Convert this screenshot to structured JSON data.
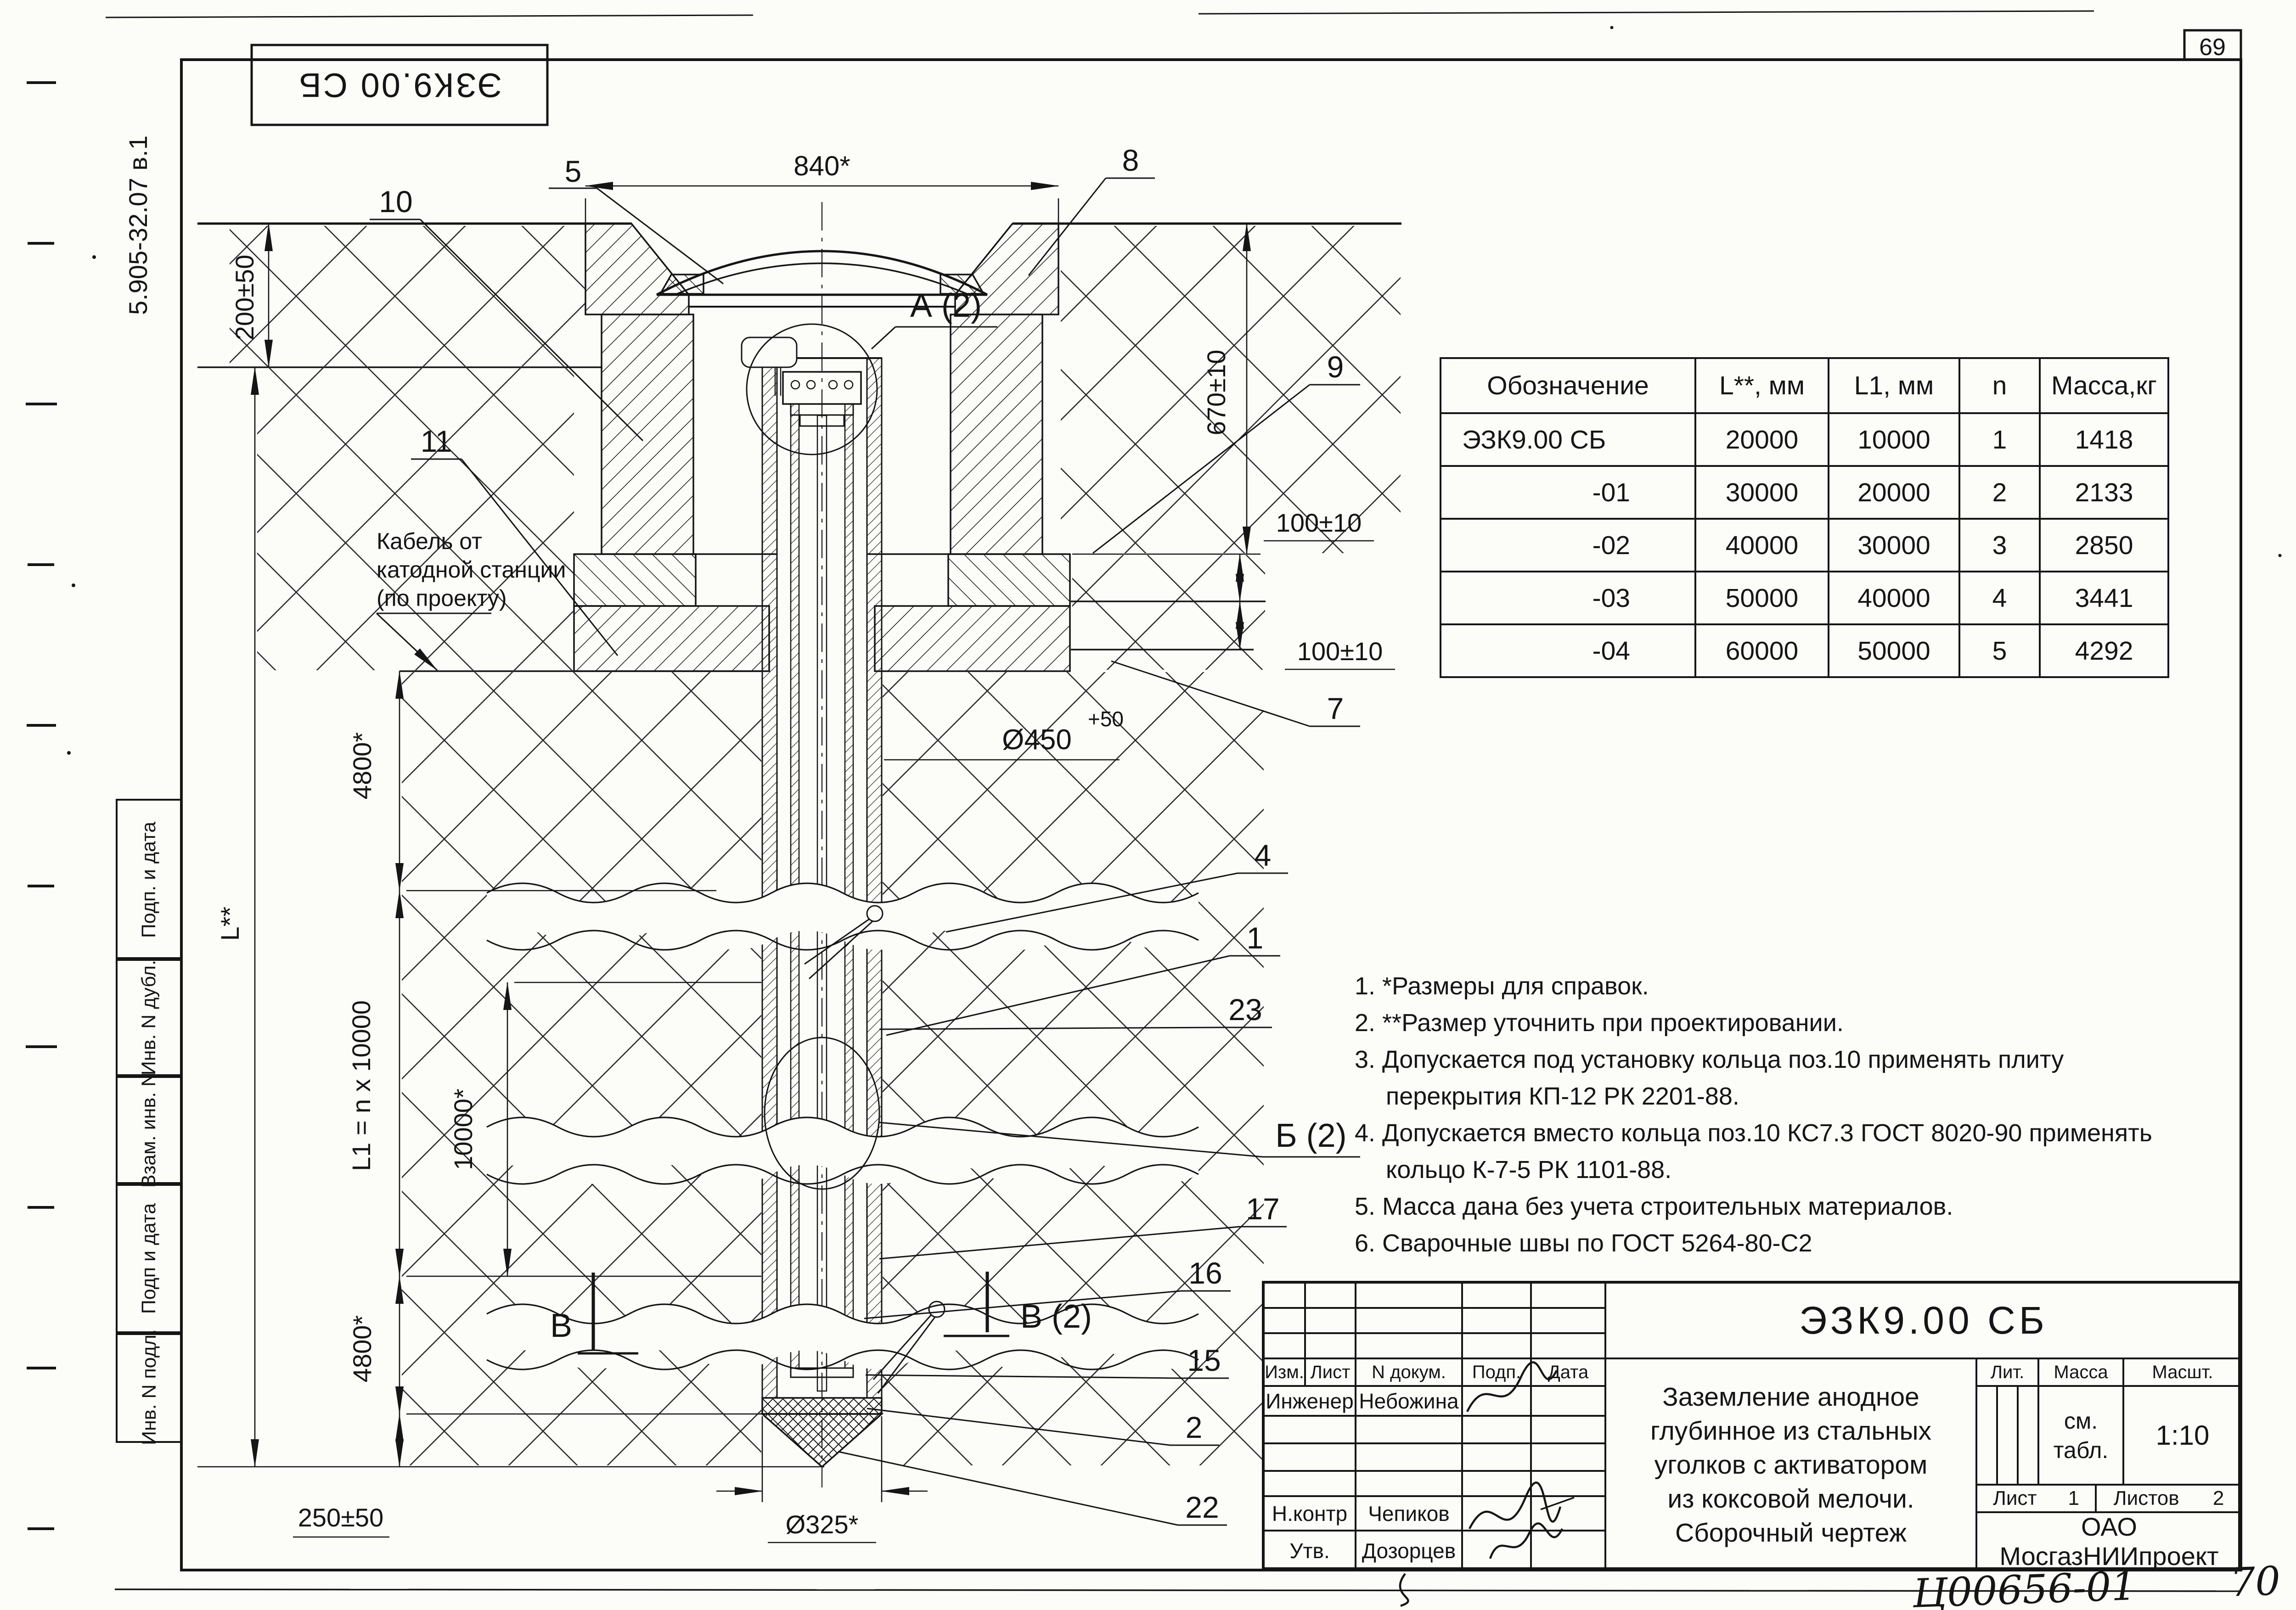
{
  "page": {
    "number": "69",
    "handwritten_code": "Ц00656-01",
    "handwritten_page": "70",
    "doc_code_vertical": "5.905-32.07 в.1",
    "top_box_label": "ЭЗК9.00 СБ"
  },
  "side_stamps": {
    "s0": "Подп. и дата",
    "s1": "Инв. N дубл.",
    "s2": "Взам. инв. N",
    "s3": "Подп и дата",
    "s4": "Инв. N подл."
  },
  "cable_note": {
    "l0": "Кабель от",
    "l1": "катодной станции",
    "l2": "(по проекту)"
  },
  "callouts": {
    "c5": "5",
    "c10": "10",
    "c8": "8",
    "c9": "9",
    "c7": "7",
    "c11": "11",
    "c4": "4",
    "c1": "1",
    "c23": "23",
    "c17": "17",
    "c16": "16",
    "c15": "15",
    "c2": "2",
    "c22": "22"
  },
  "sections": {
    "a": "А (2)",
    "b": "Б (2)",
    "v": "В",
    "v2": "В (2)"
  },
  "dims": {
    "d840": "840*",
    "d200": "200±50",
    "d670": "670±10",
    "d100a": "100±10",
    "d100b": "100±10",
    "d450": "Ø450",
    "d450sup": "+50",
    "d4800t": "4800*",
    "dl": "L**",
    "dl1": "L1 = n x 10000",
    "d10000": "10000*",
    "d4800b": "4800*",
    "d250": "250±50",
    "d325": "Ø325*"
  },
  "table": {
    "headers": [
      "Обозначение",
      "L**, мм",
      "L1, мм",
      "n",
      "Масса,кг"
    ],
    "rows": [
      [
        "ЭЗК9.00 СБ",
        "20000",
        "10000",
        "1",
        "1418"
      ],
      [
        "-01",
        "30000",
        "20000",
        "2",
        "2133"
      ],
      [
        "-02",
        "40000",
        "30000",
        "3",
        "2850"
      ],
      [
        "-03",
        "50000",
        "40000",
        "4",
        "3441"
      ],
      [
        "-04",
        "60000",
        "50000",
        "5",
        "4292"
      ]
    ]
  },
  "notes": {
    "lines": [
      "1. *Размеры для справок.",
      "2. **Размер уточнить при проектировании.",
      "3. Допускается под установку кольца поз.10 применять  плиту",
      "перекрытия КП-12 РК 2201-88.",
      "4. Допускается вместо кольца поз.10  КС7.3 ГОСТ 8020-90 применять",
      "кольцо К-7-5 РК 1101-88.",
      "5. Масса дана без учета строительных материалов.",
      "6. Сварочные швы по ГОСТ 5264-80-С2"
    ]
  },
  "title_block": {
    "designation": "ЭЗК9.00 СБ",
    "title_lines": [
      "Заземление анодное",
      "глубинное из стальных",
      "уголков с активатором",
      "из коксовой мелочи.",
      "Сборочный чертеж"
    ],
    "lit_label": "Лит.",
    "mass_label": "Масса",
    "scale_label": "Масшт.",
    "mass_value_line1": "см.",
    "mass_value_line2": "табл.",
    "scale_value": "1:10",
    "sheet_label": "Лист",
    "sheet_value": "1",
    "sheets_label": "Листов",
    "sheets_value": "2",
    "org_line1": "ОАО",
    "org_line2": "МосгазНИИпроект",
    "hdr_izm": "Изм.",
    "hdr_list": "Лист",
    "hdr_doc": "N  докум.",
    "hdr_podp": "Подп.",
    "hdr_data": "Дата",
    "role_engineer": "Инженер",
    "name_engineer": "Небожина",
    "role_ncontr": "Н.контр",
    "name_ncontr": "Чепиков",
    "role_utv": "Утв.",
    "name_utv": "Дозорцев"
  }
}
